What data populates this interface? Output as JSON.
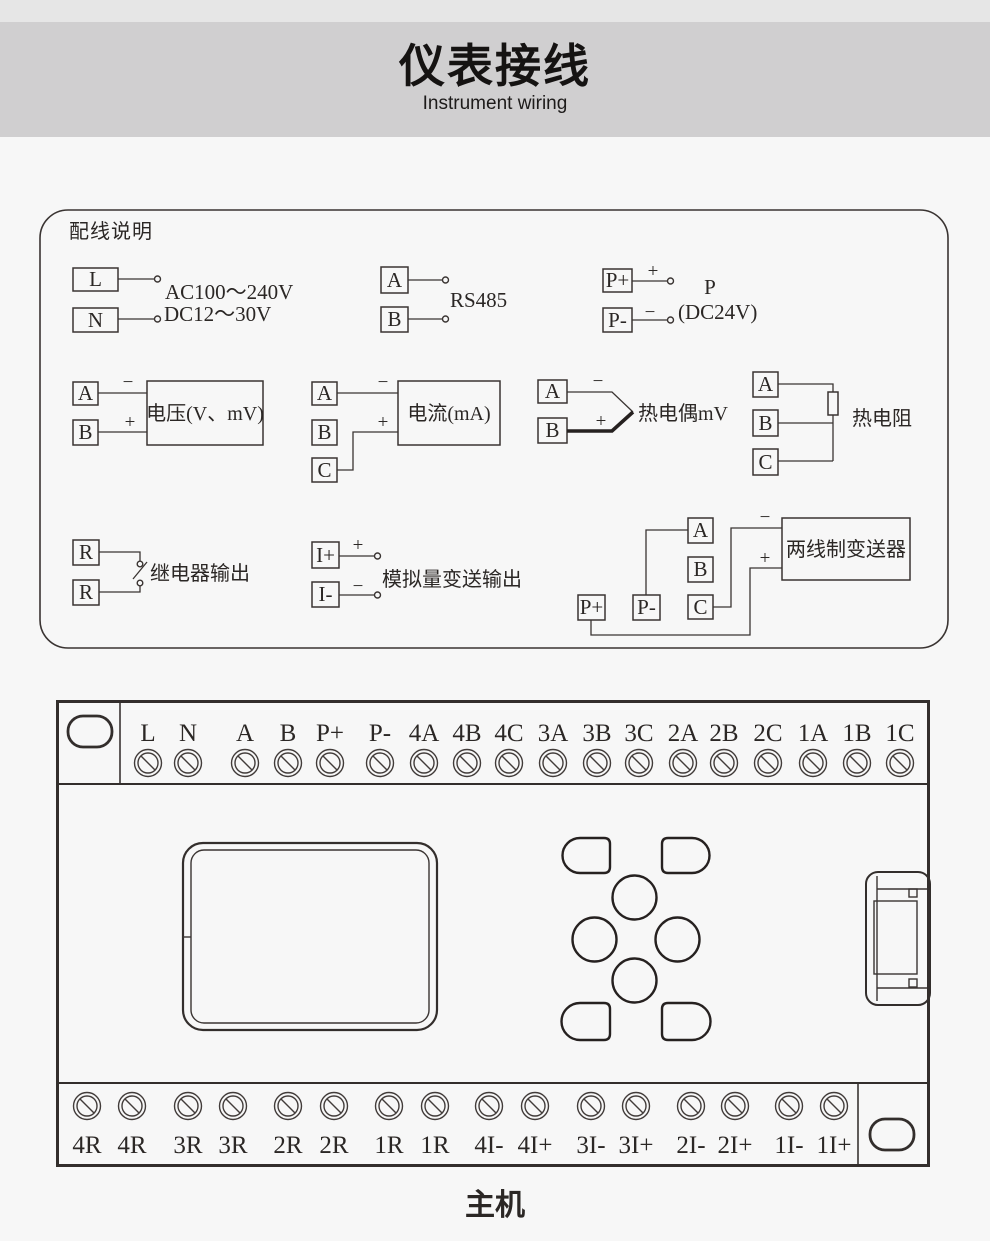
{
  "colors": {
    "page_bg": "#f7f7f7",
    "header_band": "#d0cfd0",
    "header_strip": "#e6e6e6",
    "line_dark": "#3a3432"
  },
  "header": {
    "title": "仪表接线",
    "subtitle": "Instrument wiring"
  },
  "wiring": {
    "title": "配线说明",
    "power": {
      "t1": "L",
      "t2": "N",
      "line1": "AC100～240V",
      "line2": "DC12～30V"
    },
    "rs485": {
      "t1": "A",
      "t2": "B",
      "label": "RS485"
    },
    "power24": {
      "t1": "P+",
      "t2": "P-",
      "plus": "+",
      "minus": "−",
      "label1": "P",
      "label2": "(DC24V)"
    },
    "voltage": {
      "t1": "A",
      "t2": "B",
      "minus": "−",
      "plus": "+",
      "label": "电压(V、mV)"
    },
    "current": {
      "t1": "A",
      "t2": "B",
      "t3": "C",
      "minus": "−",
      "plus": "+",
      "label": "电流(mA)"
    },
    "thermocouple": {
      "t1": "A",
      "t2": "B",
      "minus": "−",
      "plus": "+",
      "label": "热电偶mV"
    },
    "rtd": {
      "t1": "A",
      "t2": "B",
      "t3": "C",
      "label": "热电阻"
    },
    "relay": {
      "t1": "R",
      "t2": "R",
      "label": "继电器输出"
    },
    "analog_out": {
      "t1": "I+",
      "t2": "I-",
      "plus": "+",
      "minus": "−",
      "label": "模拟量变送输出"
    },
    "transmitter": {
      "t1": "A",
      "t2": "B",
      "t3": "C",
      "t4": "P+",
      "t5": "P-",
      "minus": "−",
      "plus": "+",
      "label": "两线制变送器"
    }
  },
  "device": {
    "top_terminals": [
      "L",
      "N",
      "A",
      "B",
      "P+",
      "P-",
      "4A",
      "4B",
      "4C",
      "3A",
      "3B",
      "3C",
      "2A",
      "2B",
      "2C",
      "1A",
      "1B",
      "1C"
    ],
    "bottom_terminals": [
      "4R",
      "4R",
      "3R",
      "3R",
      "2R",
      "2R",
      "1R",
      "1R",
      "4I-",
      "4I+",
      "3I-",
      "3I+",
      "2I-",
      "2I+",
      "1I-",
      "1I+"
    ],
    "caption": "主机"
  }
}
